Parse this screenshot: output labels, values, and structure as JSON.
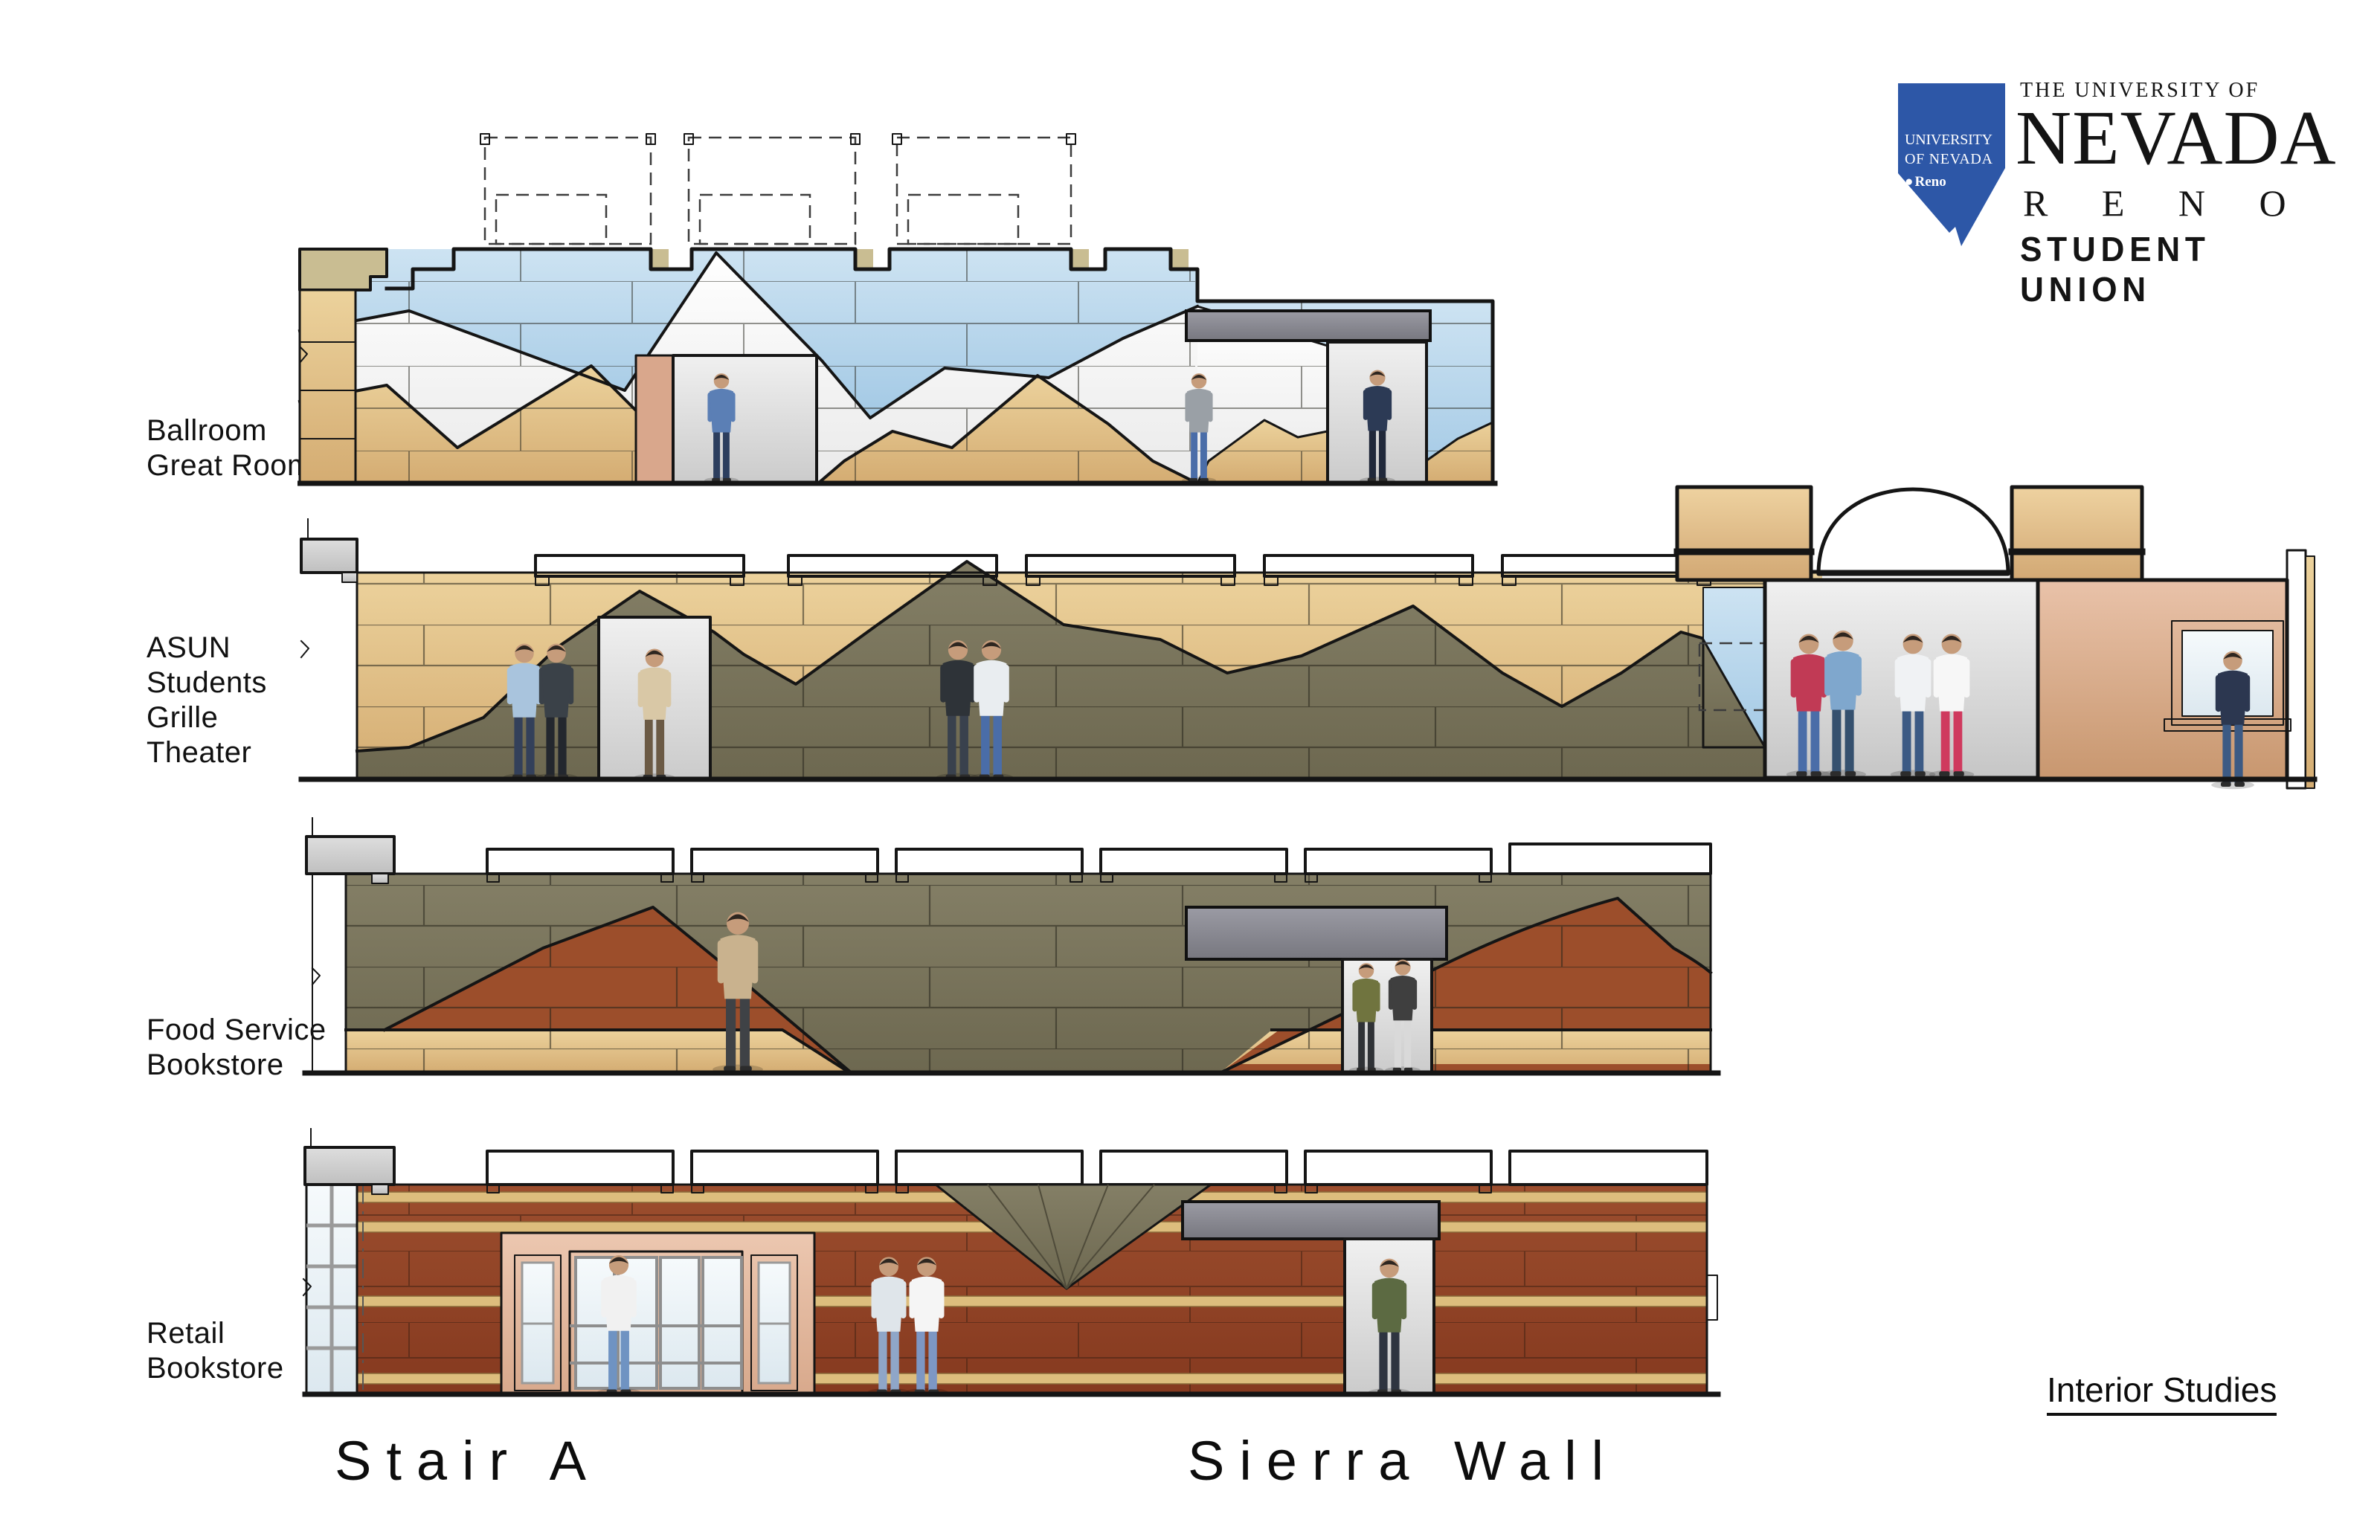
{
  "page": {
    "background": "#ffffff"
  },
  "logo": {
    "tagline": "THE UNIVERSITY OF",
    "university": "NEVADA",
    "city": "R E N O",
    "unit": "STUDENT UNION",
    "state": {
      "line1": "UNIVERSITY",
      "line2": "OF NEVADA",
      "bullet": "●",
      "city": "Reno"
    }
  },
  "elevations": [
    {
      "id": "ballroom-great-room",
      "label_lines": [
        "Ballroom",
        "Great Room"
      ]
    },
    {
      "id": "asun-students-grille-theater",
      "label_lines": [
        "ASUN",
        "Students",
        "Grille",
        "Theater"
      ]
    },
    {
      "id": "food-service-bookstore",
      "label_lines": [
        "Food Service",
        "Bookstore"
      ]
    },
    {
      "id": "retail-bookstore",
      "label_lines": [
        "Retail",
        "Bookstore"
      ]
    }
  ],
  "captions": {
    "stair": "Stair A",
    "wall": "Sierra Wall",
    "study": "Interior Studies"
  },
  "palette": {
    "pageBg": "#ffffff",
    "line": "#151515",
    "stateBlue": "#2d57a7",
    "tan": "#dcb77c",
    "khaki": "#c9bd92",
    "olive": "#7a755c",
    "rust": "#9c4e2b",
    "brick": "#8e4326",
    "stripe": "#ddbd7d",
    "blue": "#abcfe9",
    "coping": "#cccccc",
    "sign": "#8b8b95",
    "door": "#dcdcdc",
    "pinkJamb": "#d9a78c",
    "salmon": "#d4a081",
    "glass": "#e9f1f6",
    "skin": "#c69c7b"
  }
}
